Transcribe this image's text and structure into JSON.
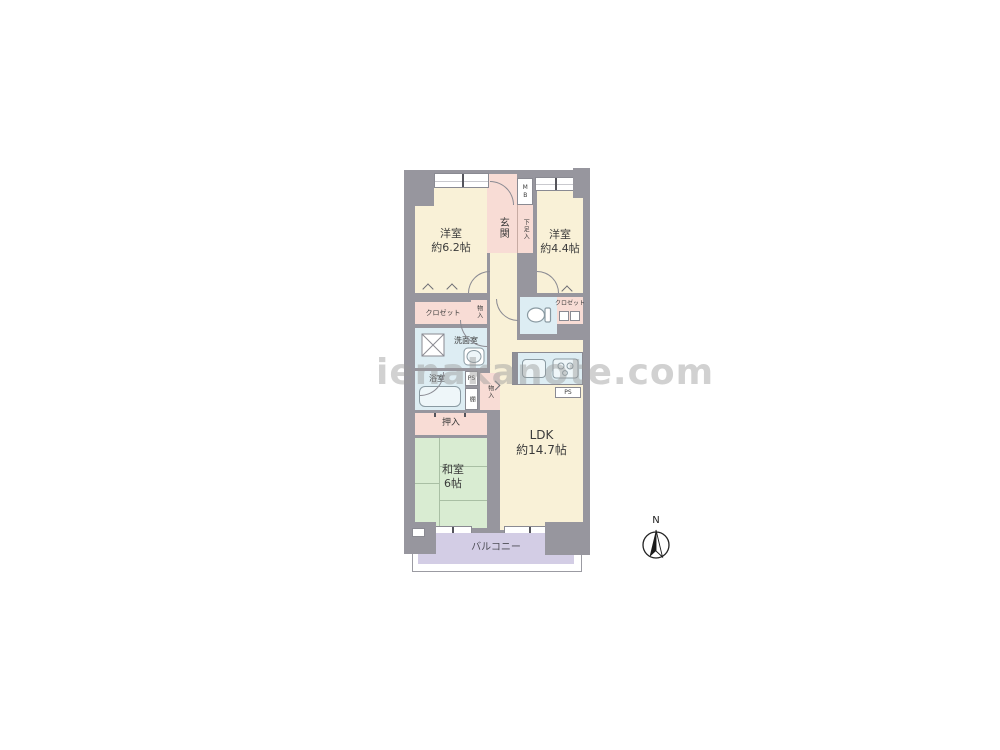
{
  "watermark": {
    "text": "ienakanote.com"
  },
  "compass": {
    "north_label": "N"
  },
  "plan": {
    "rooms": {
      "western_room_1": {
        "name": "洋室",
        "area": "約6.2帖"
      },
      "western_room_2": {
        "name": "洋室",
        "area": "約4.4帖"
      },
      "ldk": {
        "name": "LDK",
        "area": "約14.7帖"
      },
      "japanese_room": {
        "name": "和室",
        "area": "6帖"
      },
      "entrance": {
        "label": "玄関"
      },
      "shoe_cabinet": {
        "label": "下足入"
      },
      "meter_box": {
        "label": "MB"
      },
      "closet": {
        "label": "クロゼット"
      },
      "storage": {
        "label": "物入"
      },
      "washroom": {
        "label": "洗面室"
      },
      "bathroom": {
        "label": "浴室"
      },
      "shelf": {
        "label": "棚"
      },
      "pipe_space": {
        "label": "PS"
      },
      "oshiire": {
        "label": "押入"
      },
      "balcony": {
        "label": "バルコニー"
      }
    }
  },
  "colors": {
    "wall": "#97969e",
    "room-cream": "#f9f1d7",
    "room-pink": "#f8dcd5",
    "room-blue": "#ddedf3",
    "room-green": "#d9ecd2",
    "room-lavender": "#d3cde5",
    "tatami": "#a9bfa4",
    "line": "#8a8a92",
    "text": "#3b3b3b"
  }
}
